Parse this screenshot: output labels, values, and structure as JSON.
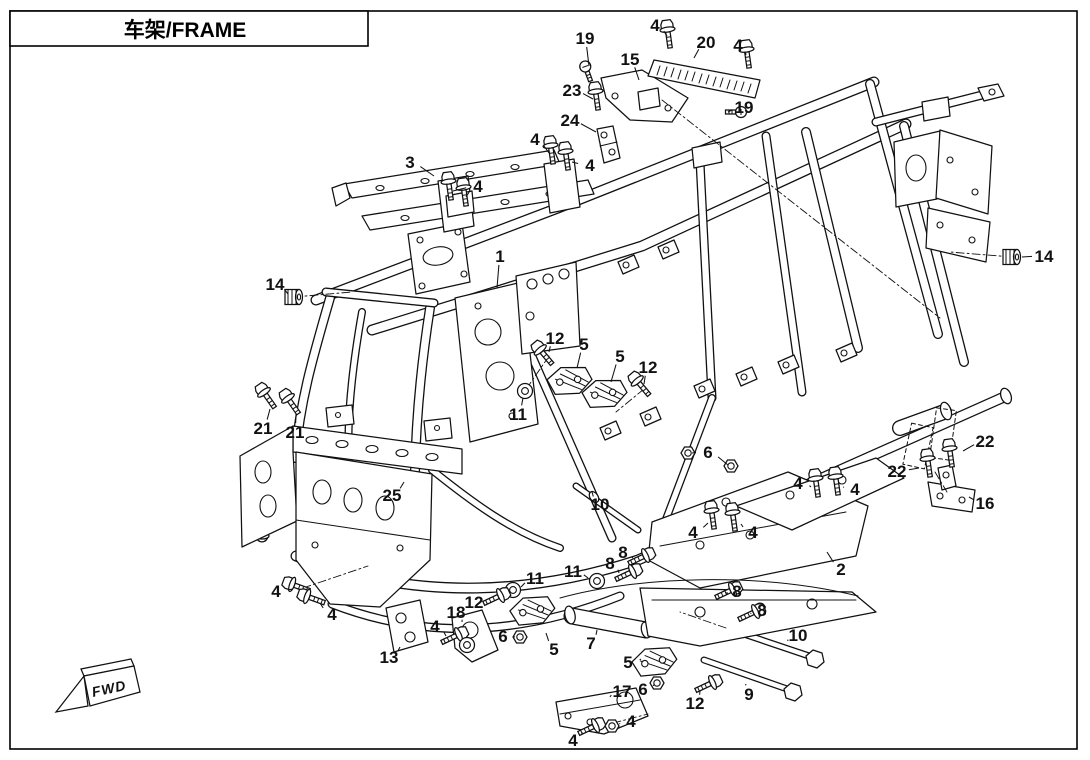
{
  "title": {
    "text": "车架/FRAME"
  },
  "fwd_label": "FWD",
  "colors": {
    "line": "#111111",
    "background": "#ffffff"
  },
  "callouts": [
    {
      "n": "19",
      "x": 585,
      "y": 38,
      "ex": 589,
      "ey": 66
    },
    {
      "n": "4",
      "x": 655,
      "y": 25,
      "ex": 667,
      "ey": 36
    },
    {
      "n": "20",
      "x": 706,
      "y": 42,
      "ex": 694,
      "ey": 58
    },
    {
      "n": "4",
      "x": 738,
      "y": 45,
      "ex": 746,
      "ey": 55
    },
    {
      "n": "15",
      "x": 630,
      "y": 59,
      "ex": 639,
      "ey": 80
    },
    {
      "n": "23",
      "x": 572,
      "y": 90,
      "ex": 593,
      "ey": 99
    },
    {
      "n": "19",
      "x": 744,
      "y": 107,
      "ex": 728,
      "ey": 112
    },
    {
      "n": "24",
      "x": 570,
      "y": 120,
      "ex": 596,
      "ey": 132
    },
    {
      "n": "4",
      "x": 535,
      "y": 139,
      "ex": 549,
      "ey": 153
    },
    {
      "n": "3",
      "x": 410,
      "y": 162,
      "ex": 434,
      "ey": 176
    },
    {
      "n": "4",
      "x": 590,
      "y": 165,
      "ex": 572,
      "ey": 162
    },
    {
      "n": "4",
      "x": 478,
      "y": 186,
      "ex": 453,
      "ey": 191,
      "ex2": 466,
      "ey2": 197
    },
    {
      "n": "1",
      "x": 500,
      "y": 256,
      "ex": 497,
      "ey": 288
    },
    {
      "n": "14",
      "x": 275,
      "y": 284,
      "ex": 288,
      "ey": 294
    },
    {
      "n": "12",
      "x": 555,
      "y": 338,
      "ex": 549,
      "ey": 352
    },
    {
      "n": "5",
      "x": 584,
      "y": 344,
      "ex": 577,
      "ey": 368
    },
    {
      "n": "5",
      "x": 620,
      "y": 356,
      "ex": 611,
      "ey": 382
    },
    {
      "n": "12",
      "x": 648,
      "y": 367,
      "ex": 644,
      "ey": 384
    },
    {
      "n": "11",
      "x": 518,
      "y": 414,
      "ex": 523,
      "ey": 398
    },
    {
      "n": "14",
      "x": 1044,
      "y": 256,
      "ex": 1022,
      "ey": 257
    },
    {
      "n": "21",
      "x": 263,
      "y": 428,
      "ex": 270,
      "ey": 409
    },
    {
      "n": "21",
      "x": 295,
      "y": 432,
      "ex": 296,
      "ey": 414
    },
    {
      "n": "25",
      "x": 392,
      "y": 495,
      "ex": 404,
      "ey": 482
    },
    {
      "n": "10",
      "x": 600,
      "y": 504,
      "ex": 592,
      "ey": 492
    },
    {
      "n": "6",
      "x": 708,
      "y": 452,
      "ex": 692,
      "ey": 453,
      "ex2": 728,
      "ey2": 465
    },
    {
      "n": "22",
      "x": 897,
      "y": 471,
      "ex": 919,
      "ey": 468
    },
    {
      "n": "22",
      "x": 985,
      "y": 441,
      "ex": 963,
      "ey": 451
    },
    {
      "n": "16",
      "x": 985,
      "y": 503,
      "ex": 969,
      "ey": 497
    },
    {
      "n": "4",
      "x": 798,
      "y": 483,
      "ex": 811,
      "ey": 487
    },
    {
      "n": "4",
      "x": 855,
      "y": 489,
      "ex": 844,
      "ey": 487
    },
    {
      "n": "4",
      "x": 693,
      "y": 532,
      "ex": 708,
      "ey": 523
    },
    {
      "n": "4",
      "x": 753,
      "y": 532,
      "ex": 741,
      "ey": 524
    },
    {
      "n": "2",
      "x": 841,
      "y": 569,
      "ex": 827,
      "ey": 552
    },
    {
      "n": "8",
      "x": 623,
      "y": 552,
      "ex": 632,
      "ey": 558
    },
    {
      "n": "8",
      "x": 610,
      "y": 563,
      "ex": 619,
      "ey": 573
    },
    {
      "n": "11",
      "x": 573,
      "y": 571,
      "ex": 588,
      "ey": 578
    },
    {
      "n": "11",
      "x": 535,
      "y": 578,
      "ex": 521,
      "ey": 587
    },
    {
      "n": "12",
      "x": 474,
      "y": 602,
      "ex": 486,
      "ey": 600
    },
    {
      "n": "18",
      "x": 456,
      "y": 612,
      "ex": 462,
      "ey": 622
    },
    {
      "n": "4",
      "x": 435,
      "y": 626,
      "ex": 446,
      "ey": 636
    },
    {
      "n": "6",
      "x": 503,
      "y": 636,
      "ex": 514,
      "ey": 637
    },
    {
      "n": "5",
      "x": 554,
      "y": 649,
      "ex": 546,
      "ey": 633
    },
    {
      "n": "7",
      "x": 591,
      "y": 643,
      "ex": 597,
      "ey": 630
    },
    {
      "n": "13",
      "x": 389,
      "y": 657,
      "ex": 400,
      "ey": 647
    },
    {
      "n": "8",
      "x": 737,
      "y": 591,
      "ex": 728,
      "ey": 593
    },
    {
      "n": "8",
      "x": 762,
      "y": 610,
      "ex": 751,
      "ey": 614
    },
    {
      "n": "10",
      "x": 798,
      "y": 635,
      "ex": 788,
      "ey": 641
    },
    {
      "n": "5",
      "x": 628,
      "y": 662,
      "ex": 641,
      "ey": 659
    },
    {
      "n": "6",
      "x": 643,
      "y": 689,
      "ex": 653,
      "ey": 685
    },
    {
      "n": "17",
      "x": 622,
      "y": 691,
      "ex": 610,
      "ey": 697
    },
    {
      "n": "12",
      "x": 695,
      "y": 703,
      "ex": 700,
      "ey": 691
    },
    {
      "n": "9",
      "x": 749,
      "y": 694,
      "ex": 746,
      "ey": 684
    },
    {
      "n": "4",
      "x": 631,
      "y": 721,
      "ex": 620,
      "ey": 724
    },
    {
      "n": "4",
      "x": 573,
      "y": 740,
      "ex": 582,
      "ey": 732
    },
    {
      "n": "4",
      "x": 276,
      "y": 591,
      "ex": 293,
      "ey": 589
    },
    {
      "n": "4",
      "x": 332,
      "y": 614,
      "ex": 320,
      "ey": 603
    }
  ],
  "hardware": [
    {
      "t": "screw",
      "x": 588,
      "y": 74,
      "r": -20
    },
    {
      "t": "bolt",
      "x": 669,
      "y": 40,
      "r": -8
    },
    {
      "t": "bolt",
      "x": 748,
      "y": 60,
      "r": -8
    },
    {
      "t": "screw",
      "x": 733,
      "y": 112,
      "r": 90
    },
    {
      "t": "bolt",
      "x": 597,
      "y": 102,
      "r": -8
    },
    {
      "t": "bolt",
      "x": 552,
      "y": 156,
      "r": -8
    },
    {
      "t": "bolt",
      "x": 567,
      "y": 162,
      "r": -8
    },
    {
      "t": "bolt",
      "x": 450,
      "y": 192,
      "r": -8
    },
    {
      "t": "bolt",
      "x": 465,
      "y": 198,
      "r": -8
    },
    {
      "t": "grommet",
      "x": 294,
      "y": 297,
      "r": 0
    },
    {
      "t": "grommet",
      "x": 1012,
      "y": 257,
      "r": 0
    },
    {
      "t": "bolt",
      "x": 547,
      "y": 358,
      "r": -40
    },
    {
      "t": "bolt",
      "x": 644,
      "y": 389,
      "r": -40
    },
    {
      "t": "washer",
      "x": 525,
      "y": 391,
      "r": 0
    },
    {
      "t": "bolt",
      "x": 270,
      "y": 401,
      "r": -35
    },
    {
      "t": "bolt",
      "x": 294,
      "y": 407,
      "r": -35
    },
    {
      "t": "nut",
      "x": 688,
      "y": 453,
      "r": 0
    },
    {
      "t": "nut",
      "x": 731,
      "y": 466,
      "r": 0
    },
    {
      "t": "bolt",
      "x": 929,
      "y": 469,
      "r": -8
    },
    {
      "t": "bolt",
      "x": 951,
      "y": 459,
      "r": -8
    },
    {
      "t": "bolt",
      "x": 817,
      "y": 489,
      "r": -8
    },
    {
      "t": "bolt",
      "x": 837,
      "y": 487,
      "r": -8
    },
    {
      "t": "bolt",
      "x": 713,
      "y": 521,
      "r": -8
    },
    {
      "t": "bolt",
      "x": 734,
      "y": 523,
      "r": -8
    },
    {
      "t": "bolt",
      "x": 302,
      "y": 588,
      "r": -70
    },
    {
      "t": "bolt",
      "x": 317,
      "y": 600,
      "r": -70
    },
    {
      "t": "bolt",
      "x": 636,
      "y": 560,
      "r": 65
    },
    {
      "t": "bolt",
      "x": 623,
      "y": 576,
      "r": 65
    },
    {
      "t": "bolt",
      "x": 723,
      "y": 594,
      "r": 65
    },
    {
      "t": "bolt",
      "x": 746,
      "y": 616,
      "r": 65
    },
    {
      "t": "washer",
      "x": 513,
      "y": 590,
      "r": 0
    },
    {
      "t": "washer",
      "x": 597,
      "y": 581,
      "r": 0
    },
    {
      "t": "bolt",
      "x": 491,
      "y": 600,
      "r": 65
    },
    {
      "t": "bolt",
      "x": 449,
      "y": 639,
      "r": 65
    },
    {
      "t": "washer",
      "x": 467,
      "y": 645,
      "r": 0
    },
    {
      "t": "nut",
      "x": 520,
      "y": 637,
      "r": 0
    },
    {
      "t": "nut",
      "x": 657,
      "y": 683,
      "r": 0
    },
    {
      "t": "bolt",
      "x": 703,
      "y": 687,
      "r": 65
    },
    {
      "t": "bolt",
      "x": 586,
      "y": 730,
      "r": 65
    },
    {
      "t": "nut",
      "x": 612,
      "y": 726,
      "r": 0
    },
    {
      "t": "mount",
      "x": 570,
      "y": 382,
      "r": -12
    },
    {
      "t": "mount",
      "x": 605,
      "y": 395,
      "r": -12
    },
    {
      "t": "mount",
      "x": 533,
      "y": 612,
      "r": -15
    },
    {
      "t": "mount",
      "x": 655,
      "y": 663,
      "r": -15
    }
  ]
}
